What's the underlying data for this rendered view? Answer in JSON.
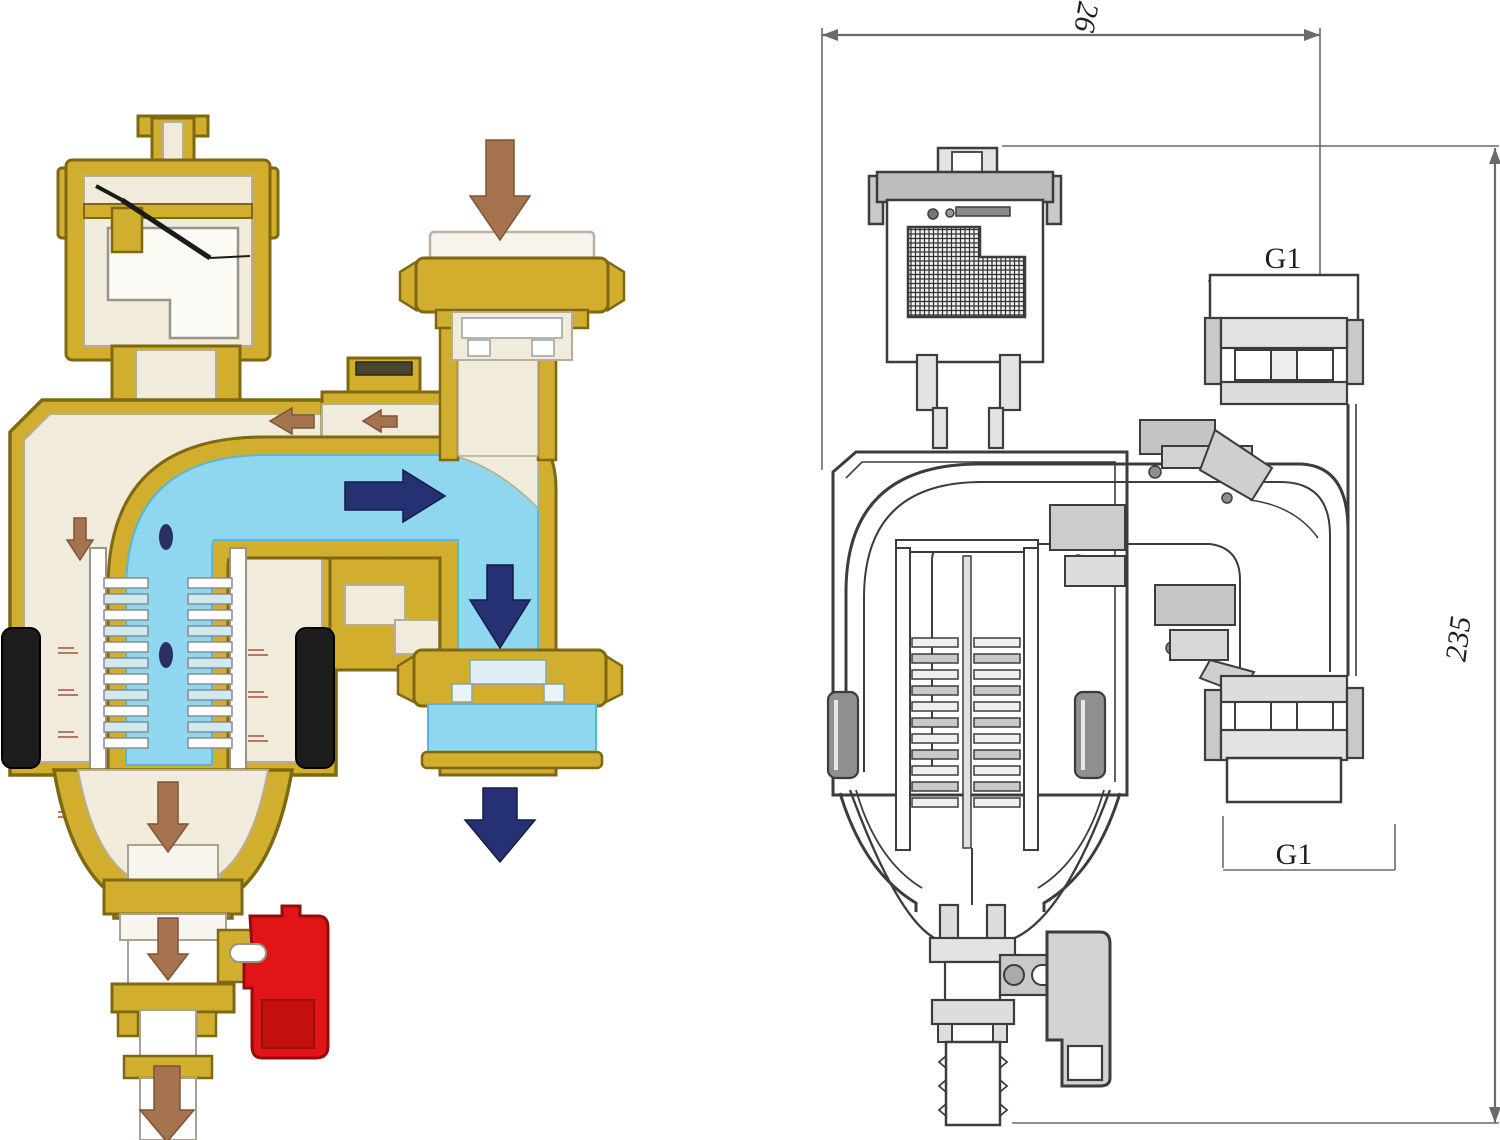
{
  "figure": {
    "type": "product cross-section diagram",
    "subject": "magnetic dirt separator filter with automatic air vent, flow tee and drain valve",
    "panels": {
      "left": {
        "style": "colored cutaway illustration showing water flow"
      },
      "right": {
        "style": "engineering sectional line drawing with dimensions"
      }
    }
  },
  "dimensions": {
    "width_label": "126",
    "height_label": "235",
    "top_port_label": "G1",
    "bottom_port_label": "G1"
  },
  "flow": {
    "inlet_direction": "down",
    "channel_direction": "right",
    "outlet_direction": "down",
    "drain_direction": "down",
    "vent_recirculation": "left"
  },
  "colors": {
    "brass": "#d2ae2e",
    "brass-dark": "#7e6812",
    "brass-light": "#e7cf5e",
    "cream": "#f1ebdb",
    "cream-line": "#b6ad96",
    "water": "#8ed7ee",
    "water-dark": "#58b7d6",
    "navy": "#253173",
    "brown": "#a5734e",
    "red": "#e11515",
    "red-dark": "#930d0d",
    "magnet": "#1d1d1d",
    "ink": "#3c3c3c",
    "dim-line": "#6a6a6a",
    "metal-light": "#e3e3e3",
    "metal-mid": "#c9c9c9",
    "metal-dark": "#9a9a9a",
    "paper": "#ffffff"
  }
}
